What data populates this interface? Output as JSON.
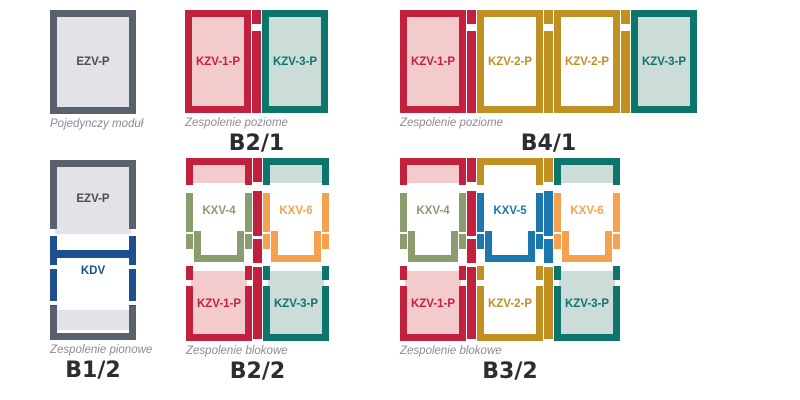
{
  "colors": {
    "red": "#c2203f",
    "pink": "#f3cbcd",
    "teal": "#0e756d",
    "teal_light": "#ccdcd8",
    "gold": "#c09122",
    "olive": "#8b9c6e",
    "orange": "#f5a14d",
    "blue": "#1c77ad",
    "navy": "#1d4f91",
    "gray": "#5a616e",
    "gray_light": "#e3e3e7",
    "caption_text": "#8c8c92",
    "title_text": "#2c2c33",
    "background": "#ffffff"
  },
  "groups": {
    "single": {
      "caption": "Pojedynczy moduł",
      "modules": {
        "m1": "EZV-P"
      }
    },
    "b21": {
      "title": "B2/1",
      "caption": "Zespolenie poziome",
      "modules": {
        "m1": "KZV-1-P",
        "m2": "KZV-3-P"
      }
    },
    "b41": {
      "title": "B4/1",
      "caption": "Zespolenie poziome",
      "modules": {
        "m1": "KZV-1-P",
        "m2": "KZV-2-P",
        "m3": "KZV-2-P",
        "m4": "KZV-3-P"
      }
    },
    "b12": {
      "title": "B1/2",
      "caption": "Zespolenie pionowe",
      "modules": {
        "m1": "EZV-P",
        "m2": "KDV"
      }
    },
    "b22": {
      "title": "B2/2",
      "caption": "Zespolenie blokowe",
      "modules": {
        "m1": "KXV-4",
        "m2": "KXV-6",
        "m3": "KZV-1-P",
        "m4": "KZV-3-P"
      }
    },
    "b32": {
      "title": "B3/2",
      "caption": "Zespolenie blokowe",
      "modules": {
        "m1": "KXV-4",
        "m2": "KXV-5",
        "m3": "KXV-6",
        "m4": "KZV-1-P",
        "m5": "KZV-2-P",
        "m6": "KZV-3-P"
      }
    }
  }
}
